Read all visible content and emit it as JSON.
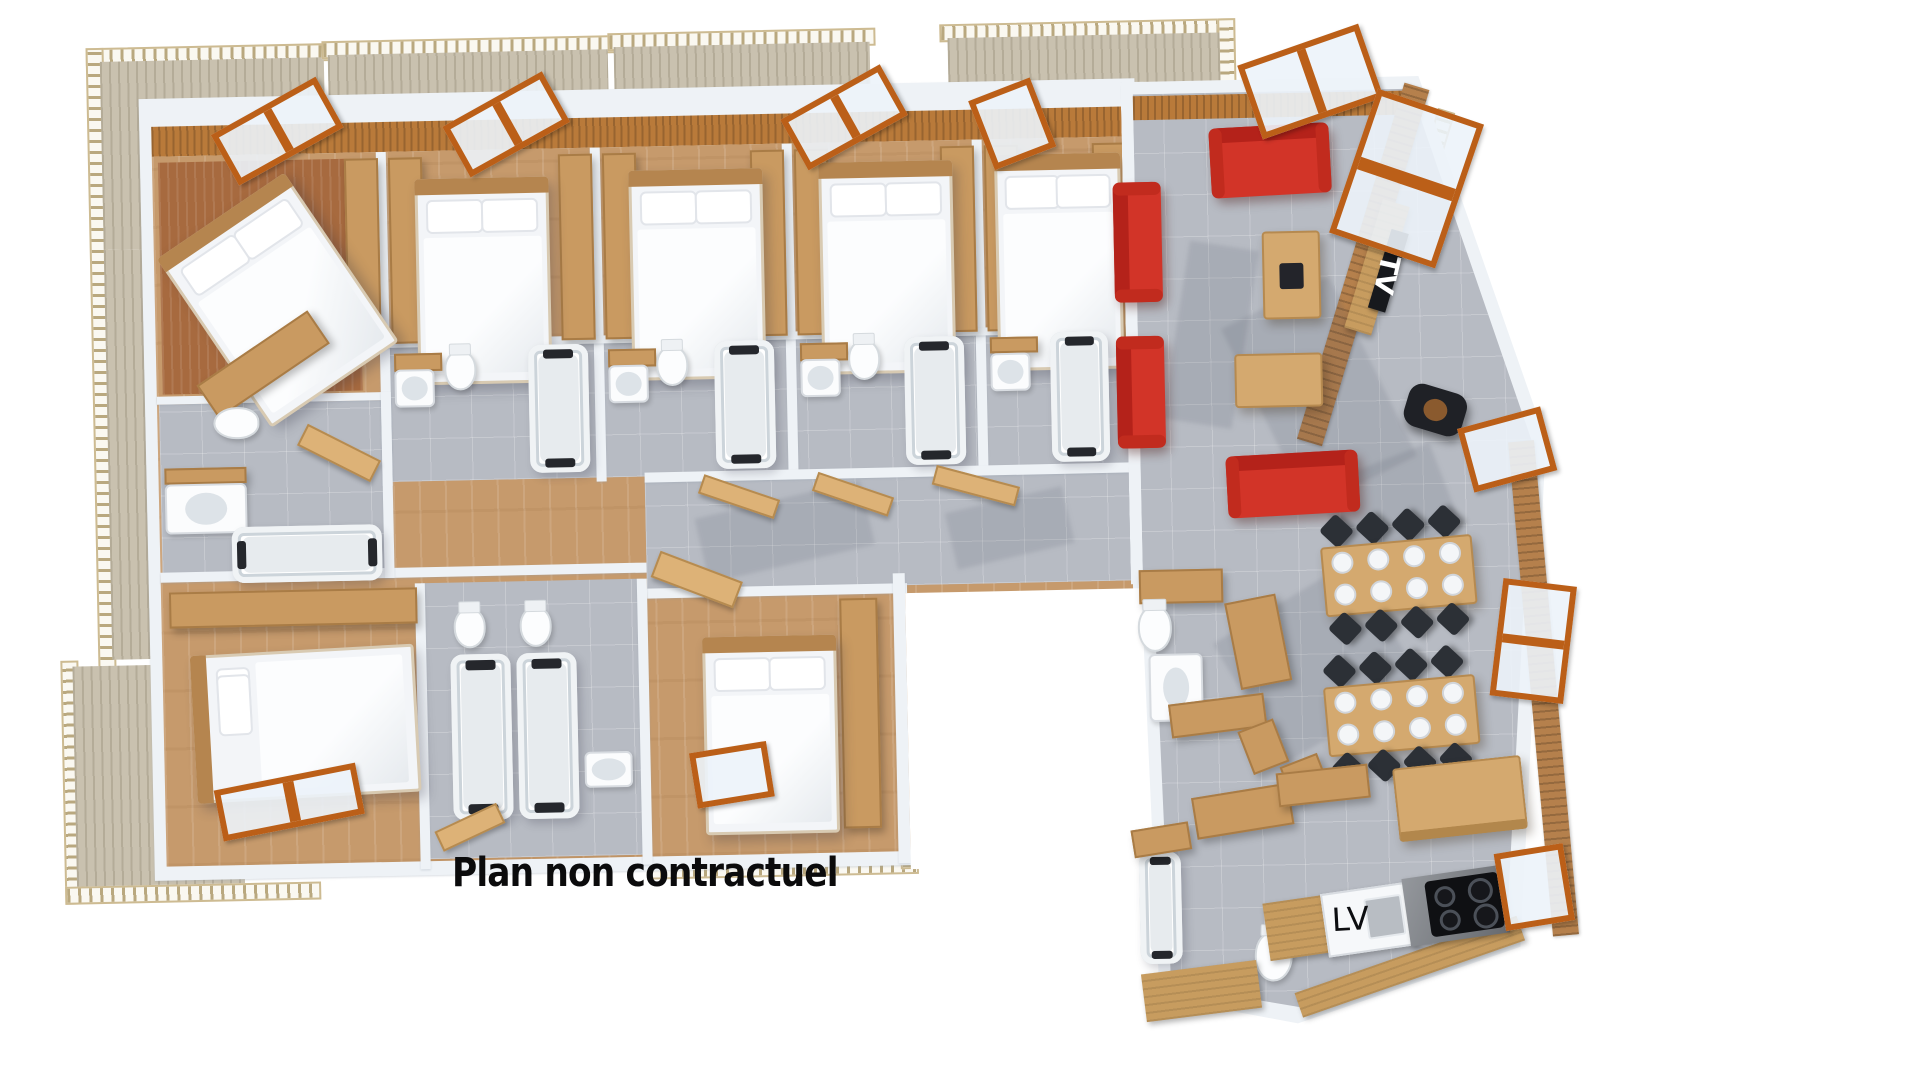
{
  "labels": {
    "disclaimer": "Plan non contractuel",
    "tv": "TV",
    "dishwasher": "LV"
  },
  "colors": {
    "background": "#ffffff",
    "wall_white": "#eef2f6",
    "wood_floor_tan": "#c69a6c",
    "wood_floor_rust": "#a76a3f",
    "tile_gray": "#b7bbc3",
    "sofa_red": "#d23428",
    "window_frame_orange": "#bb5f18",
    "furniture_wood": "#d4a96f",
    "chair_black": "#2c3036",
    "counter_gray": "#7d8187",
    "text_black": "#0b0b0c",
    "tv_text_white": "#ffffff"
  }
}
